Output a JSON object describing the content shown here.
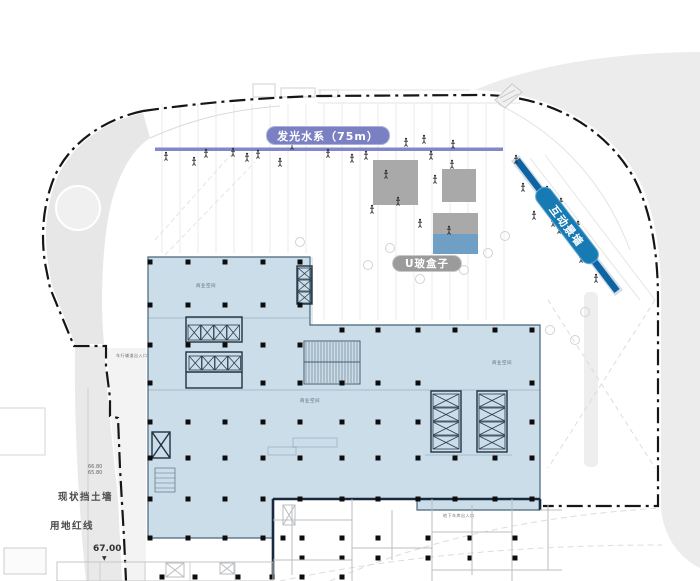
{
  "site_plan": {
    "water_feature": {
      "label": "发光水系（75m）"
    },
    "uglass_box": {
      "label": "U玻盒子"
    },
    "interactive_wall": {
      "label": "互动景墙"
    },
    "annotations": {
      "retaining_wall": "现状挡土墙",
      "red_line": "用地红线",
      "elevation_main": "67.00",
      "elevation_marker": "▼",
      "elevation_upper": "66.80",
      "elevation_lower": "65.80",
      "space_label_1": "商业空间",
      "space_label_2": "商业空间",
      "space_label_3": "商业空间",
      "entrance_label_west": "车行辅道出入口",
      "entrance_label_south": "地下车库出入口"
    },
    "colors": {
      "building_fill": "#cbdde9",
      "building_border": "#46657a",
      "water_purple": "#8287c8",
      "wall_blue": "#0e63a2",
      "wall_pill_blue": "#177ab3",
      "uglass_gray": "#a9a9a9",
      "uglass_blue": "#6f9fc4",
      "boundary_black": "#161616",
      "column_black": "#0d0d0d",
      "outside_gray": "#ececec"
    }
  }
}
